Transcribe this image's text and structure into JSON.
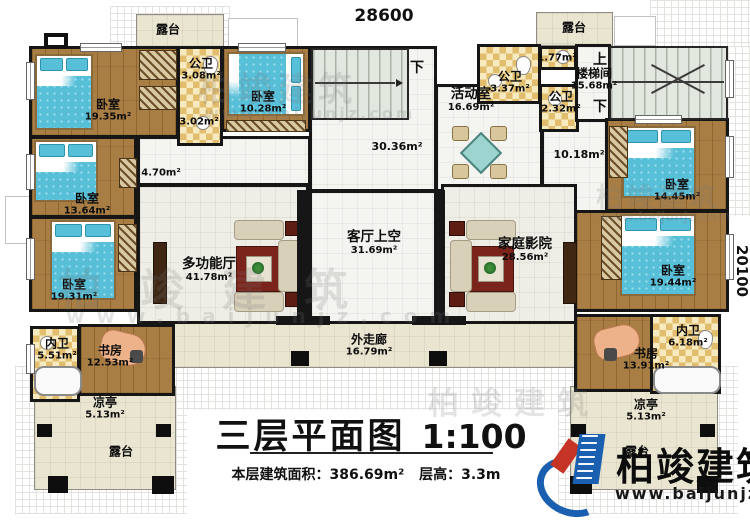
{
  "plan": {
    "dimension_top": "28600",
    "dimension_right": "20100"
  },
  "stairs": {
    "up": "上",
    "down": "下"
  },
  "rooms": {
    "terrace_top_left": {
      "label": "露台"
    },
    "terrace_top_right": {
      "label": "露台"
    },
    "terrace_bottom_left": {
      "label": "露台"
    },
    "terrace_bottom_right": {
      "label": "露台"
    },
    "bedroom_1935": {
      "label": "卧室",
      "area": "19.35m²"
    },
    "bath_308": {
      "label": "公卫",
      "area": "3.08m²"
    },
    "hall_302": {
      "area": "3.02m²"
    },
    "bedroom_1028": {
      "label": "卧室",
      "area": "10.28m²"
    },
    "hall_3036": {
      "area": "30.36m²"
    },
    "activity_room": {
      "label": "活动室",
      "area": "16.69m²"
    },
    "bath_337": {
      "label": "公卫",
      "area": "3.37m²"
    },
    "hall_177": {
      "area": "1.77m²"
    },
    "bath_232": {
      "label": "公卫",
      "area": "2.32m²"
    },
    "stair_hall": {
      "label": "楼梯间",
      "area": "15.68m²"
    },
    "hall_470": {
      "area": "4.70m²"
    },
    "hall_1018": {
      "area": "10.18m²"
    },
    "bedroom_1364": {
      "label": "卧室",
      "area": "13.64m²"
    },
    "bedroom_1445": {
      "label": "卧室",
      "area": "14.45m²"
    },
    "multi_function_hall": {
      "label": "多功能厅",
      "area": "41.78m²"
    },
    "living_room_void": {
      "label": "客厅上空",
      "area": "31.69m²"
    },
    "home_theater": {
      "label": "家庭影院",
      "area": "28.56m²"
    },
    "bedroom_1931": {
      "label": "卧室",
      "area": "19.31m²"
    },
    "bedroom_1944": {
      "label": "卧室",
      "area": "19.44m²"
    },
    "bath_551": {
      "label": "内卫",
      "area": "5.51m²"
    },
    "study_left": {
      "label": "书房",
      "area": "12.53m²"
    },
    "study_right": {
      "label": "书房",
      "area": "13.91m²"
    },
    "bath_618": {
      "label": "内卫",
      "area": "6.18m²"
    },
    "pavilion_left": {
      "label": "凉亭",
      "area": "5.13m²"
    },
    "pavilion_right": {
      "label": "凉亭",
      "area": "5.13m²"
    },
    "corridor": {
      "label": "外走廊",
      "area": "16.79m²"
    }
  },
  "title": {
    "name": "三层平面图",
    "scale": "1:100",
    "floor_area_label": "本层建筑面积：",
    "floor_area_value": "386.69m²",
    "floor_height_label": "层高：",
    "floor_height_value": "3.3m"
  },
  "logo": {
    "brand": "柏竣建筑",
    "website": "www.baijunjz.com"
  },
  "watermark": {
    "brand": "柏竣建筑",
    "website": "www.baijunjz.com"
  }
}
